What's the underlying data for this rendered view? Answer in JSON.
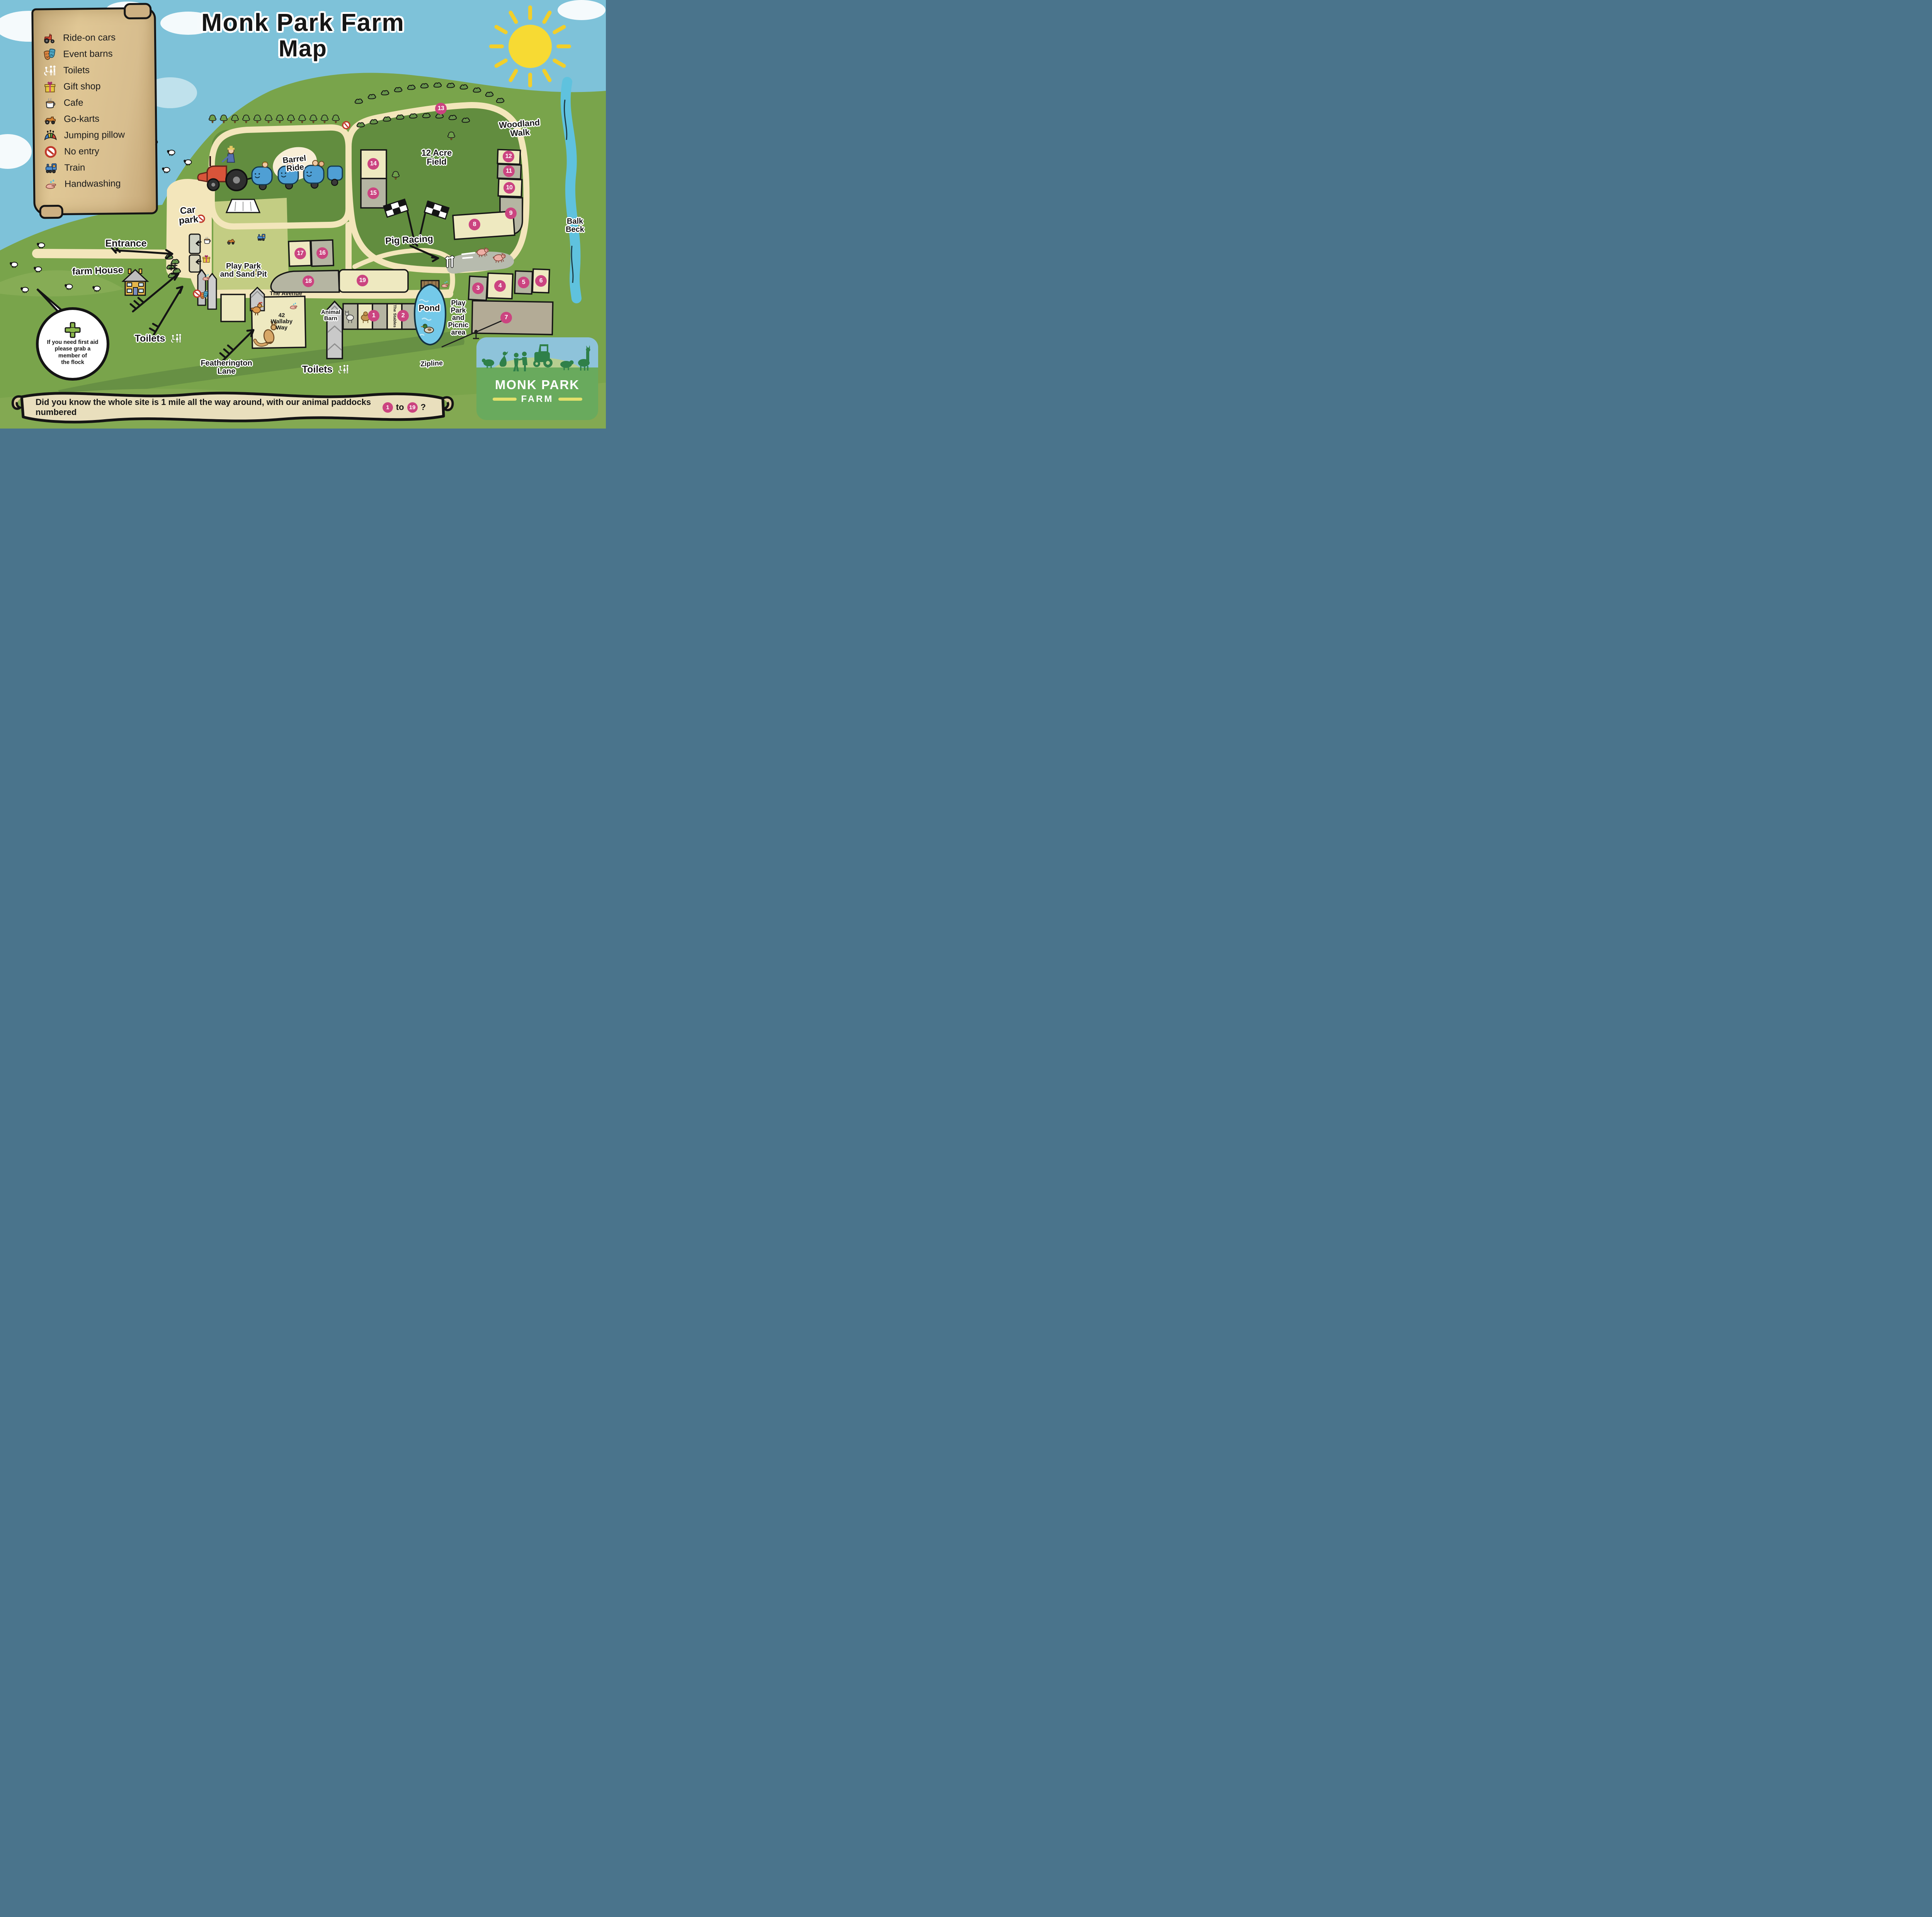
{
  "title": {
    "line1": "Monk Park Farm",
    "line2": "Map"
  },
  "legend": {
    "items": [
      {
        "icon": "ride-on-cars-icon",
        "label": "Ride-on cars"
      },
      {
        "icon": "event-barns-icon",
        "label": "Event barns"
      },
      {
        "icon": "toilets-icon",
        "label": "Toilets"
      },
      {
        "icon": "gift-shop-icon",
        "label": "Gift shop"
      },
      {
        "icon": "cafe-icon",
        "label": "Cafe"
      },
      {
        "icon": "go-karts-icon",
        "label": "Go-karts"
      },
      {
        "icon": "jumping-pillow-icon",
        "label": "Jumping pillow"
      },
      {
        "icon": "no-entry-icon",
        "label": "No entry"
      },
      {
        "icon": "train-icon",
        "label": "Train"
      },
      {
        "icon": "handwashing-icon",
        "label": "Handwashing"
      }
    ]
  },
  "map_labels": {
    "woodland_walk": "Woodland\nWalk",
    "twelve_acre_field": "12 Acre\nField",
    "barrel_ride": "Barrel\nRide",
    "car_park": "Car\npark",
    "entrance": "Entrance",
    "farm_house": "farm House",
    "play_park_sand_pit": "Play Park\nand Sand Pit",
    "pig_racing": "Pig Racing",
    "the_avenue": "The Avenue",
    "wallaby_way": "42\nWallaby\nWay",
    "animal_barn": "Animal\nBarn",
    "the_stables": "The Stables",
    "pond": "Pond",
    "play_park_picnic": "Play\nPark\nand\nPicnic\narea",
    "zipline": "Zipline",
    "featherington_lane": "Featherington\nLane",
    "toilets_west": "Toilets",
    "toilets_south": "Toilets",
    "balk_beck": "Balk\nBeck"
  },
  "first_aid": {
    "text": "If you need first aid\nplease grab a\nmember of\nthe flock"
  },
  "banner": {
    "text_before": "Did you know the whole site is 1 mile all the way around, with our animal paddocks numbered",
    "badge_start": "1",
    "text_middle": "to",
    "badge_end": "19",
    "text_after": "?"
  },
  "logo": {
    "name_line1": "MONK PARK",
    "name_line2": "FARM"
  },
  "paddocks": [
    "1",
    "2",
    "3",
    "4",
    "5",
    "6",
    "7",
    "8",
    "9",
    "10",
    "11",
    "12",
    "13",
    "14",
    "15",
    "16",
    "17",
    "18",
    "19"
  ],
  "colors": {
    "badge_pink": "#cb4480",
    "path_cream": "#f3e6bb",
    "grass_green": "#79a44b",
    "farm_green": "#628d3f",
    "sky_blue": "#7ec2d9",
    "parchment": "#d9c08e",
    "pond_blue": "#74c9e9"
  }
}
